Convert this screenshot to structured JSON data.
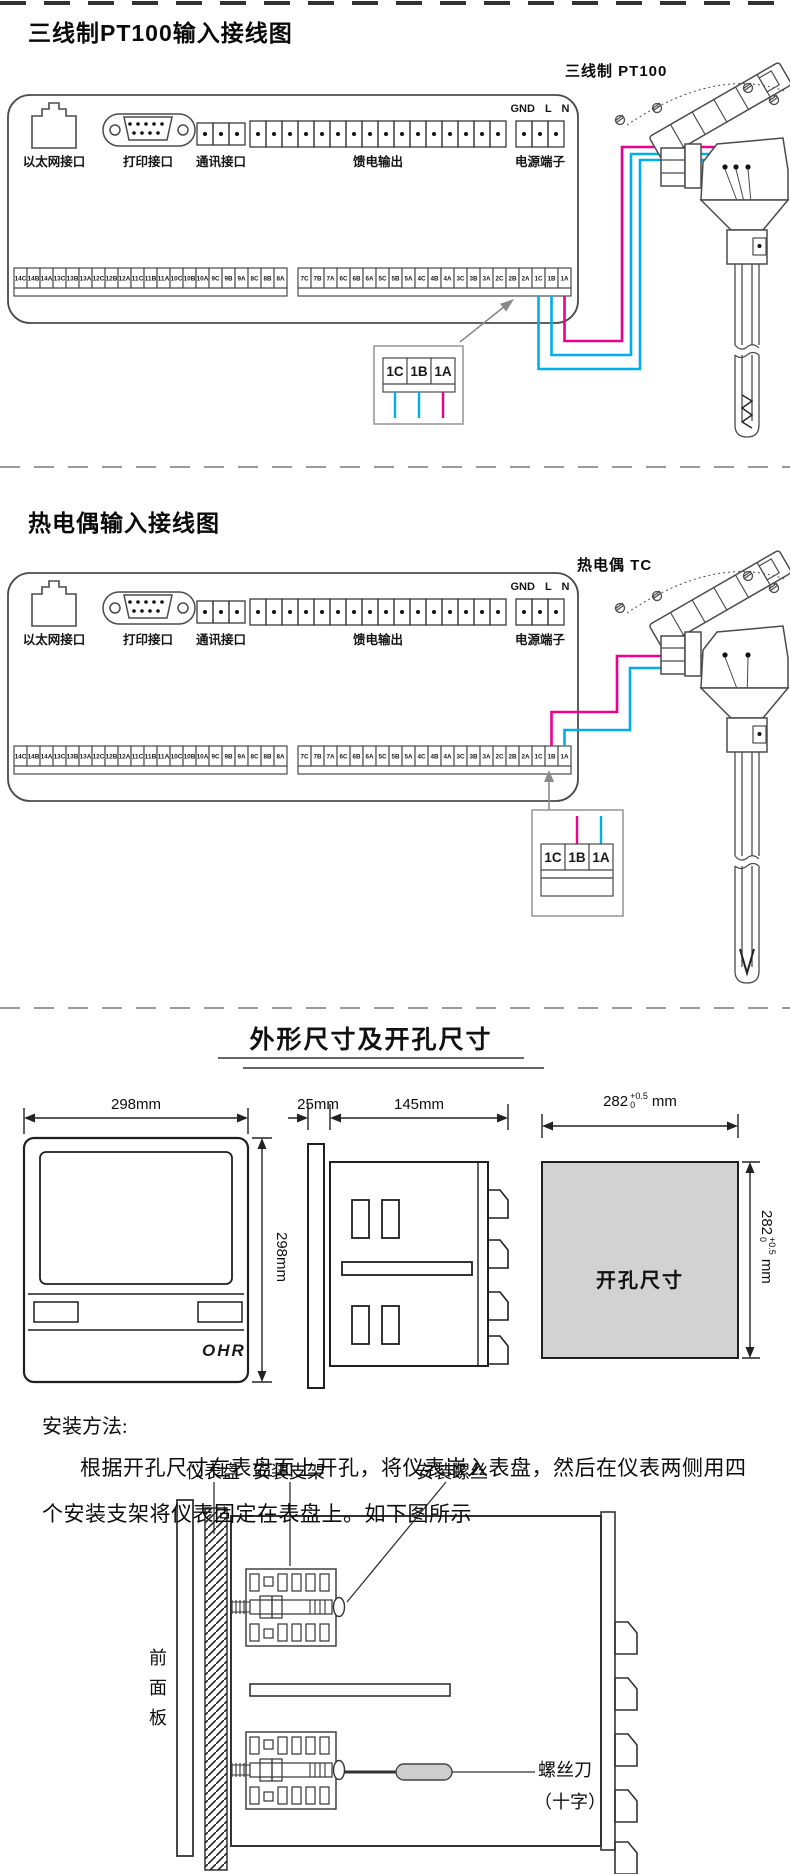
{
  "colors": {
    "wire_pink": "#ec008c",
    "wire_blue": "#00aeef",
    "cutout_fill": "#d2d2d2"
  },
  "section1": {
    "title": "三线制PT100输入接线图",
    "sensor_label": "三线制 PT100"
  },
  "section2": {
    "title": "热电偶输入接线图",
    "sensor_label": "热电偶 TC"
  },
  "panel_labels": {
    "ethernet": "以太网接口",
    "printer": "打印接口",
    "comm": "通讯接口",
    "feed": "馈电输出",
    "power": "电源端子",
    "power_pins": "GND L N"
  },
  "strips": {
    "left": [
      "14C",
      "14B",
      "14A",
      "13C",
      "13B",
      "13A",
      "12C",
      "12B",
      "12A",
      "11C",
      "11B",
      "11A",
      "10C",
      "10B",
      "10A",
      "9C",
      "9B",
      "9A",
      "8C",
      "8B",
      "8A"
    ],
    "right": [
      "7C",
      "7B",
      "7A",
      "6C",
      "6B",
      "6A",
      "5C",
      "5B",
      "5A",
      "4C",
      "4B",
      "4A",
      "3C",
      "3B",
      "3A",
      "2C",
      "2B",
      "2A",
      "1C",
      "1B",
      "1A"
    ],
    "detail": [
      "1C",
      "1B",
      "1A"
    ]
  },
  "section3": {
    "title": "外形尺寸及开孔尺寸",
    "front": {
      "width": "298mm",
      "height": "298mm",
      "logo": "OHR"
    },
    "side": {
      "bezel": "25mm",
      "depth": "145mm"
    },
    "cutout": {
      "label": "开孔尺寸",
      "width_value": "282",
      "width_tol_top": "+0.5",
      "width_tol_bottom": "0",
      "width_unit": "mm",
      "height_value": "282",
      "height_tol_top": "+0.5",
      "height_tol_bottom": "0",
      "height_unit": "mm"
    },
    "install": {
      "heading": "安装方法:",
      "line1": "根据开孔尺寸在表盘面上开孔，将仪表嵌入表盘，然后在仪表两侧用四",
      "line2": "个安装支架将仪表固定在表盘上。如下图所示"
    },
    "labels": {
      "panel": "仪表盘",
      "bracket": "安装支架",
      "screw": "安装螺丝",
      "front_panel": "前面板",
      "screwdriver": "螺丝刀",
      "screwdriver_type": "（十字）"
    }
  }
}
